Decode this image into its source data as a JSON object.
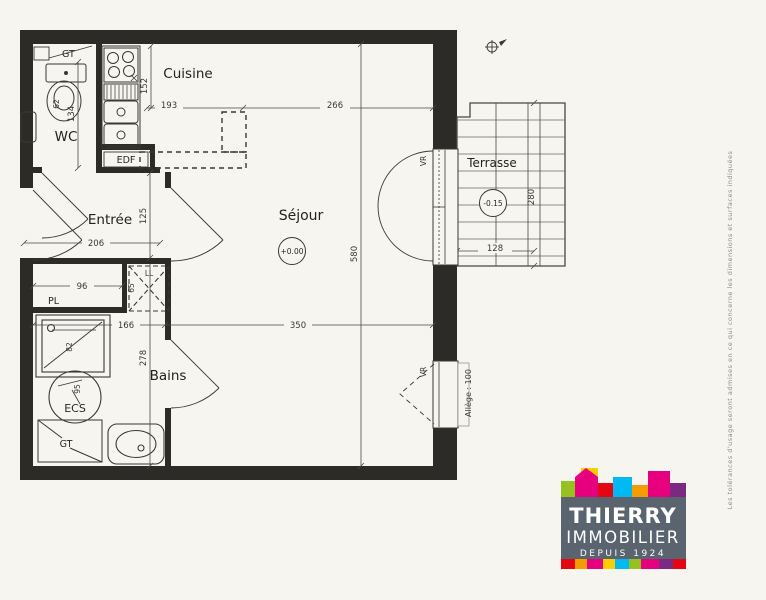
{
  "plan": {
    "rooms": {
      "cuisine": "Cuisine",
      "wc": "WC",
      "entree": "Entrée",
      "sejour": "Séjour",
      "bains": "Bains",
      "terrasse": "Terrasse"
    },
    "fixtures": {
      "gt_top": "GT",
      "edf": "EDF",
      "pl": "PL",
      "ll": "LL",
      "ecs": "ECS",
      "gt_bottom": "GT"
    },
    "windows": {
      "vr_door": "VR",
      "vr_window": "VR",
      "allege": "Allège : 100"
    },
    "levels": {
      "sejour": "+0.00",
      "terrasse": "-0.15"
    },
    "dims": {
      "d134": "134",
      "d152": "152",
      "d193": "193",
      "d266": "266",
      "d580": "580",
      "d206": "206",
      "d125": "125",
      "d278": "278",
      "d96": "96",
      "d65": "65",
      "d62": "62",
      "d82": "82",
      "d95": "95",
      "d166": "166",
      "d350": "350",
      "d280": "280",
      "d128": "128"
    },
    "disclaimer": "Les tolérances d'usage seront admises en ce qui concerne les dimensions et surfaces indiquées"
  },
  "logo": {
    "line1": "THIERRY",
    "line2": "IMMOBILIER",
    "line3": "DEPUIS 1924",
    "colors": {
      "slate": "#59646f",
      "lime": "#96c11f",
      "yellow": "#ffcd00",
      "magenta": "#e6007e",
      "red": "#e30613",
      "cyan": "#00b9f2",
      "orange": "#f59c00",
      "purple": "#7b2982"
    }
  }
}
